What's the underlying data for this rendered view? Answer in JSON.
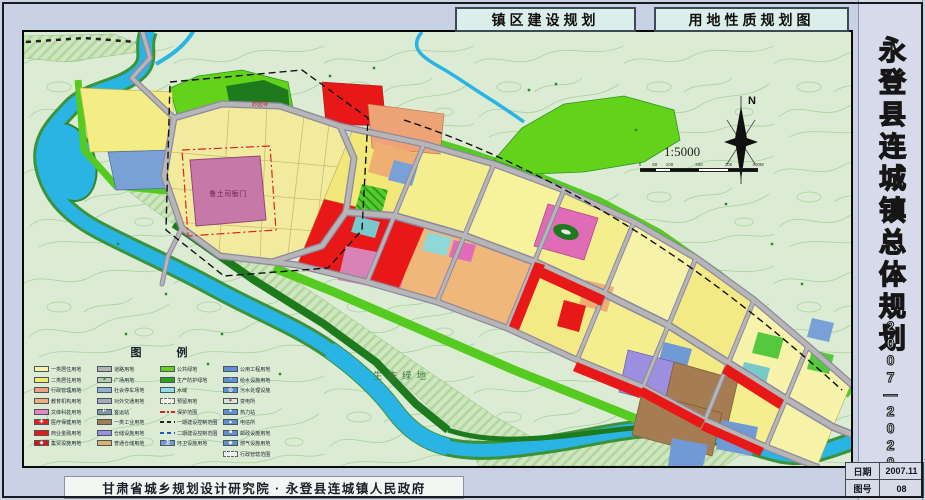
{
  "header": {
    "title_left": "镇区建设规划",
    "title_right": "用地性质规划图"
  },
  "sidebar": {
    "title": "永登县连城镇总体规划",
    "years": "2007—2020",
    "info": [
      {
        "label": "日期",
        "value": "2007.11"
      },
      {
        "label": "图号",
        "value": "08"
      }
    ]
  },
  "footer": {
    "credit": "甘肃省城乡规划设计研究院 · 永登县连城镇人民政府"
  },
  "map": {
    "labels": {
      "heritage": "鲁土司衙门",
      "temple": "妙因寺",
      "eco": "生态绿地"
    },
    "compass": {
      "north": "N",
      "scale": "1:5000",
      "scalebar_ticks": [
        "0",
        "50",
        "100",
        "200",
        "300",
        "400M"
      ]
    },
    "legend": {
      "title": "图  例",
      "columns": [
        [
          {
            "label": "一类居住用地",
            "color": "#f7f3a6"
          },
          {
            "label": "二类居住用地",
            "color": "#f2e96e"
          },
          {
            "label": "行政管理用地",
            "color": "#ef9f7d"
          },
          {
            "label": "教育机构用地",
            "color": "#eeb07d"
          },
          {
            "label": "文体科技用地",
            "color": "#e586c6"
          },
          {
            "label": "医疗保健用地",
            "color": "#e82020",
            "mark": "✚",
            "markColor": "#ffffff"
          },
          {
            "label": "商业金融用地",
            "color": "#e81818"
          },
          {
            "label": "集贸设施用地",
            "color": "#d81414",
            "mark": "◆",
            "markColor": "#ffffff"
          }
        ],
        [
          {
            "label": "道路用地",
            "color": "#b3b3b3"
          },
          {
            "label": "广场用地",
            "color": "#b9c9b3",
            "mark": "▲",
            "markColor": "#2f9426"
          },
          {
            "label": "社会停车场地",
            "color": "#8fb0d0"
          },
          {
            "label": "对外交通用地",
            "color": "#a9a9c0"
          },
          {
            "label": "客运站",
            "color": "#8a93a6",
            "mark": "P",
            "markColor": "#ffffff"
          },
          {
            "label": "一类工业用地",
            "color": "#a67c52"
          },
          {
            "label": "仓储设施用地",
            "color": "#9d8fe0"
          },
          {
            "label": "普通仓储用地",
            "color": "#ddb070"
          }
        ],
        [
          {
            "label": "公共绿地",
            "color": "#62d318"
          },
          {
            "label": "生产防护绿地",
            "color": "#2ca01c"
          },
          {
            "label": "水域",
            "color": "#8fdcec"
          },
          {
            "label": "预留用地",
            "color": "#f2f2e4",
            "border": "dashed"
          },
          {
            "label": "保护范围",
            "type": "line",
            "lineColor": "#e02020",
            "lineStyle": "dashdot"
          },
          {
            "label": "一期建设控制范围",
            "type": "line",
            "lineColor": "#222222",
            "lineStyle": "dash"
          },
          {
            "label": "二期建设控制范围",
            "type": "line",
            "lineColor": "#2255cc",
            "lineStyle": "dash"
          },
          {
            "label": "环卫设施用地",
            "color": "#6f9ad6",
            "mark": "卫",
            "markColor": "#ffffff"
          }
        ],
        [
          {
            "label": "公用工程用地",
            "color": "#5e8fd0"
          },
          {
            "label": "给水设施用地",
            "color": "#5e8fd0",
            "mark": "○",
            "markColor": "#ffffff"
          },
          {
            "label": "污水处理设施",
            "color": "#5e8fd0",
            "mark": "◎",
            "markColor": "#ffffff"
          },
          {
            "label": "变电所",
            "color": "#d6e8de",
            "mark": "✦",
            "markColor": "#e02020"
          },
          {
            "label": "热力站",
            "color": "#5e8fd0",
            "mark": "●",
            "markColor": "#ffffff"
          },
          {
            "label": "电信所",
            "color": "#5e8fd0",
            "mark": "▲",
            "markColor": "#ffffff"
          },
          {
            "label": "邮政设施用地",
            "color": "#5e8fd0",
            "mark": "■",
            "markColor": "#ffffff"
          },
          {
            "label": "燃气设施用地",
            "color": "#5e8fd0",
            "mark": "◆",
            "markColor": "#ffffff"
          },
          {
            "label": "行政管辖范围",
            "color": "#eef0f4",
            "border": "dashed"
          }
        ]
      ]
    }
  },
  "colors": {
    "water": "#2ab4e4",
    "park": "#62d318",
    "forest": "#1d7a1d",
    "road": "#b6b6b6",
    "residential1": "#f7f3a6",
    "residential2": "#f2e96e",
    "commercial": "#e81818",
    "industry": "#a67c52",
    "warehouse": "#9d8fe0",
    "heritage": "#c678a8"
  }
}
